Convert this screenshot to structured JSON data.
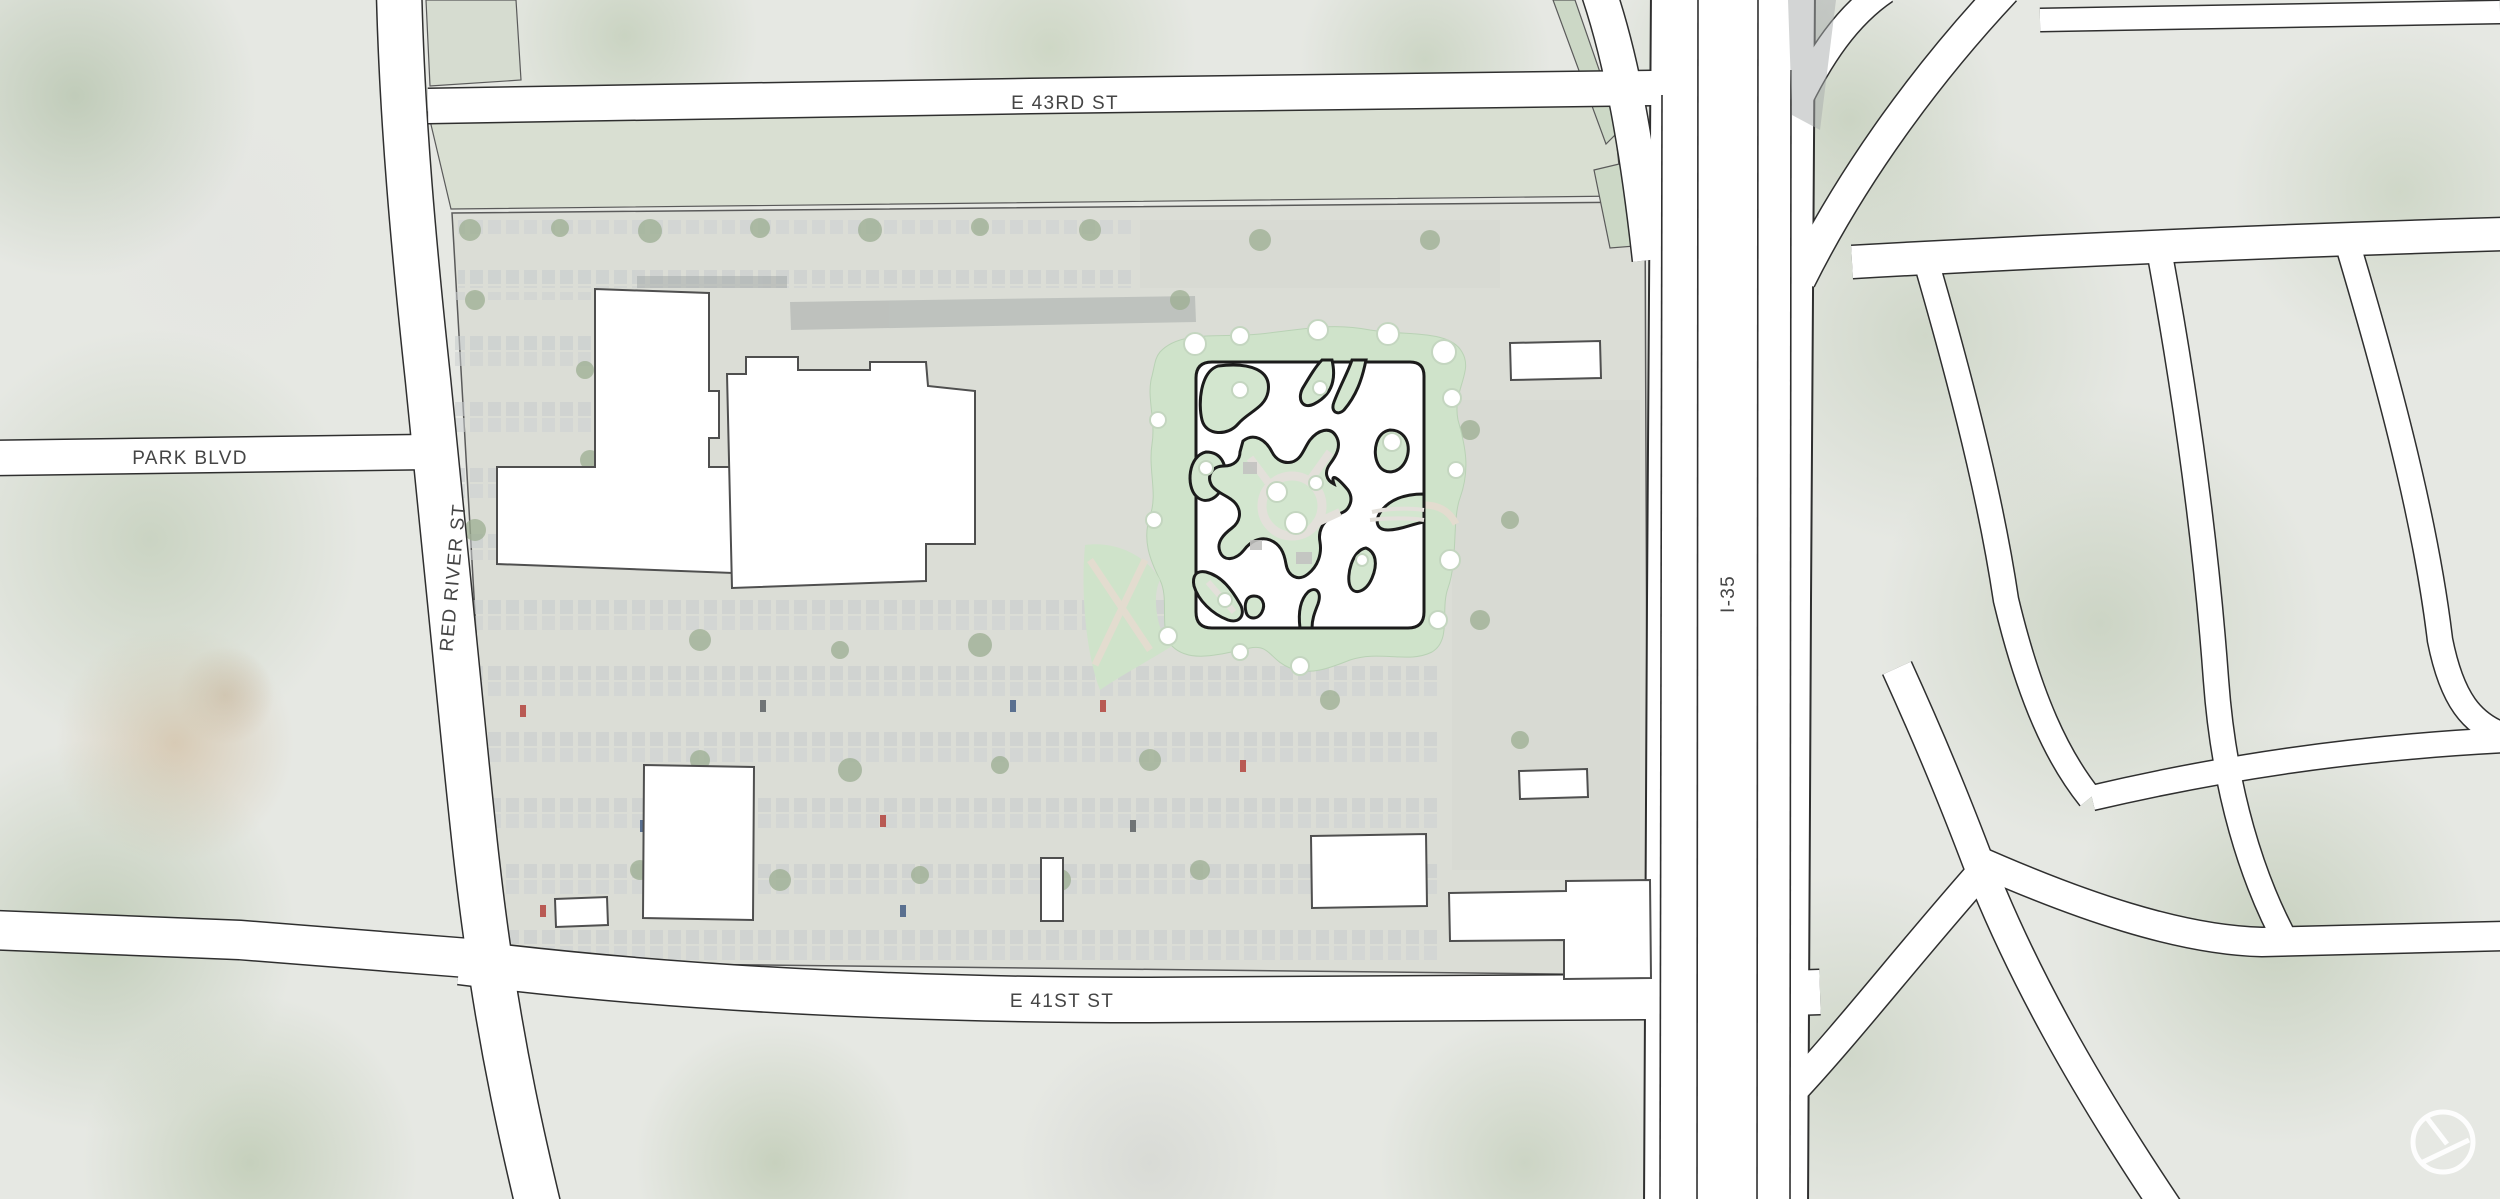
{
  "map": {
    "type": "architectural-site-plan-aerial",
    "streets": {
      "e_43rd": "E 43RD ST",
      "park_blvd": "PARK BLVD",
      "red_river": "RED RIVER ST",
      "i_35": "I-35",
      "e_41st": "E 41ST ST"
    },
    "colors": {
      "road_fill": "#ffffff",
      "road_casing": "#2f2f2f",
      "label_text": "#454545",
      "building_fill": "#ffffff",
      "building_outline": "#4f4f4f",
      "plan_outline": "#1b1b1b",
      "landscape_green": "#cfe3ca",
      "courtyard_green": "#d3e6cf",
      "path_beige": "#e3e0da",
      "aerial_base": "#e6e8e3",
      "site_base": "#dbddd6"
    },
    "icons": {
      "north_arrow": "north-arrow-icon"
    }
  }
}
